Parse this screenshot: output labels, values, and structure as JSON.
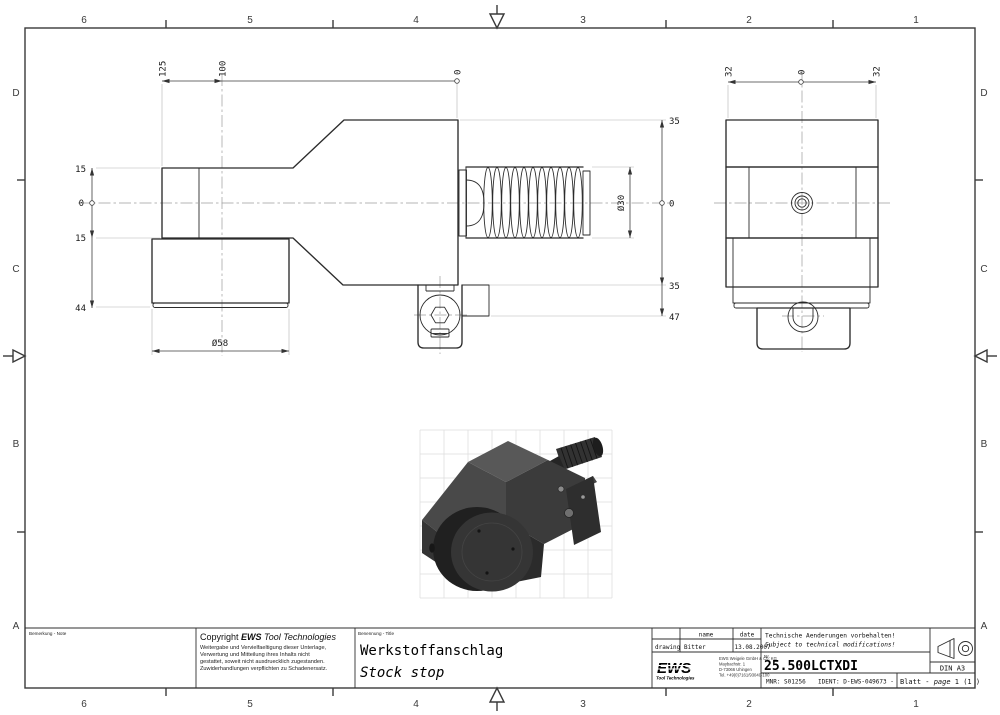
{
  "border": {
    "cols": [
      "6",
      "5",
      "4",
      "3",
      "2",
      "1"
    ],
    "rows": [
      "D",
      "C",
      "B",
      "A"
    ]
  },
  "front_view": {
    "top_dims": [
      "125",
      "100",
      "0"
    ],
    "left_dims": [
      "15",
      "0",
      "15",
      "44"
    ],
    "right_dims": [
      "35",
      "0",
      "35",
      "47"
    ],
    "thread_dia": "Ø30",
    "body_dia": "Ø58"
  },
  "side_view": {
    "top_dims": [
      "32",
      "0",
      "32"
    ]
  },
  "colors": {
    "line": "#2b2b2b",
    "centerline": "#9c9c9c",
    "iso_body_dark": "#2b2b2b",
    "iso_body_top": "#585858"
  },
  "title_block": {
    "bemerkung_label": "Bemerkung - Note",
    "benennung_label": "Benennung - Title",
    "copyright": {
      "prefix": "Copyright ",
      "brand": "EWS",
      "suffix": " Tool Technologies",
      "lines": [
        "Weitergabe und Vervielfaeltigung dieser Unterlage,",
        "Verwertung und Mitteilung ihres Inhalts nicht",
        "gestattet, soweit nicht ausdruecklich zugestanden.",
        "Zuwiderhandlungen verpflichten zu Schadenersatz."
      ]
    },
    "title_de": "Werkstoffanschlag",
    "title_en": "Stock stop",
    "approval": {
      "name_header": "name",
      "date_header": "date",
      "row_label": "drawing",
      "name": "Bitter",
      "date": "13.08.2007"
    },
    "logo": {
      "brand": "EWS",
      "sub": "Tool Technologies",
      "address": [
        "EWS Weigele GmbH & Co. KG",
        "Maybachstr. 1",
        "D-73066 Uhingen",
        "Tel. +49(0)7161/93040-100"
      ]
    },
    "notice_de": "Technische Aenderungen vorbehalten!",
    "notice_en": "Subject to technical modifications!",
    "nr_label": "Nr.",
    "part_number": "25.500LCTXDI",
    "mnr": "MNR: S01256",
    "ident": "IDENT: D-EWS-049673 -",
    "sheet": {
      "label": "Blatt - ",
      "page_word": "page",
      "value": " 1 (1 )"
    },
    "format": "DIN A3",
    "projection_icon": "first-angle-projection-icon"
  }
}
